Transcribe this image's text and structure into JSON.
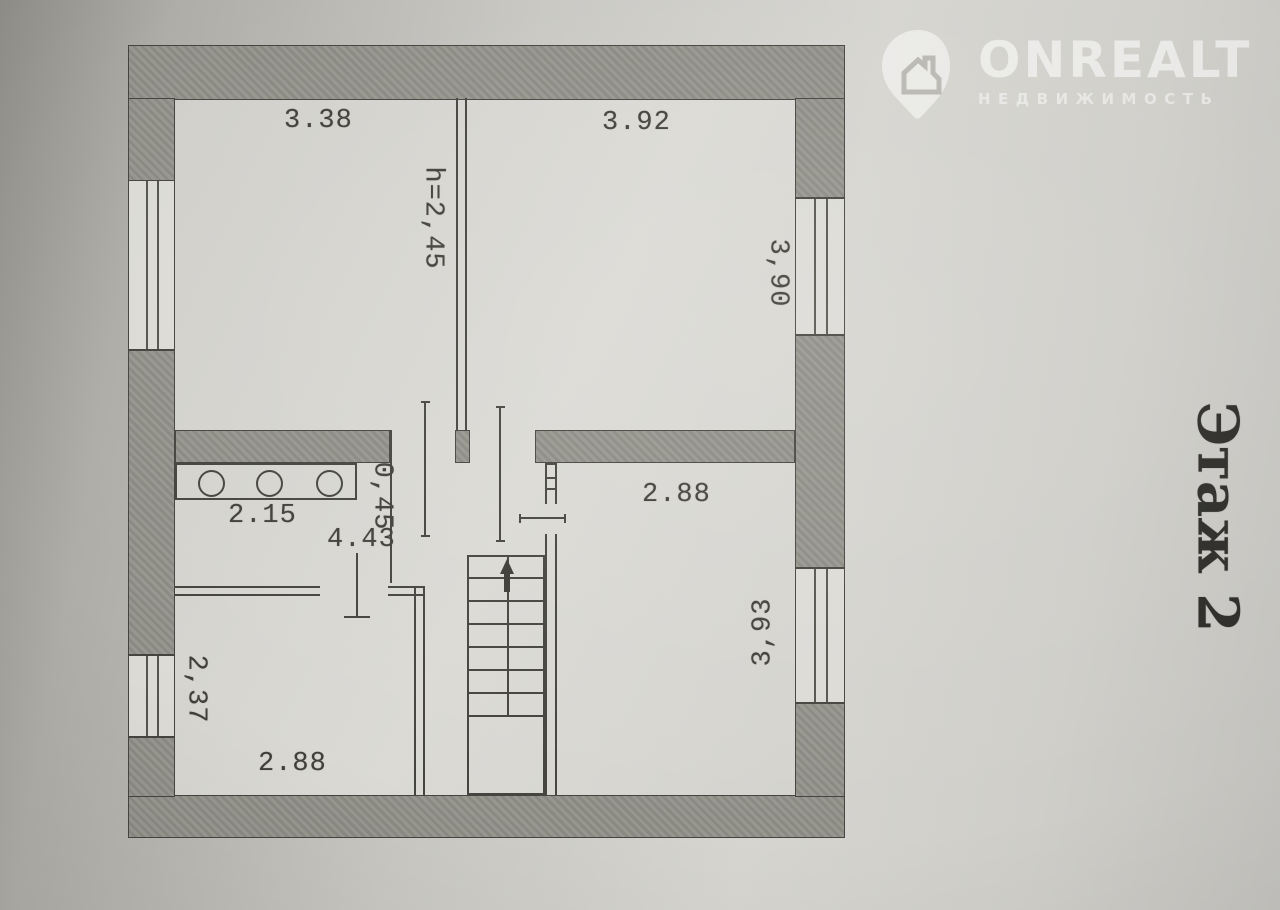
{
  "watermark": {
    "brand": "ONREALT",
    "subtitle": "НЕДВИЖИМОСТЬ"
  },
  "floor_title": "Этаж 2",
  "dimensions": {
    "room_top_left_width": "3.38",
    "room_top_right_width": "3.92",
    "ceiling_height": "h=2,45",
    "room_top_right_depth": "3,90",
    "room_right_width": "2.88",
    "opening_width": "0,45",
    "hall_length": "4.43",
    "counter_width": "2.15",
    "room_bottom_left_depth": "2,37",
    "room_bottom_left_width": "2.88",
    "room_right_depth": "3,93"
  },
  "colors": {
    "paper": "#d6d5d0",
    "wall_fill": "#91908b",
    "line": "#45443e",
    "watermark": "#ffffff"
  }
}
